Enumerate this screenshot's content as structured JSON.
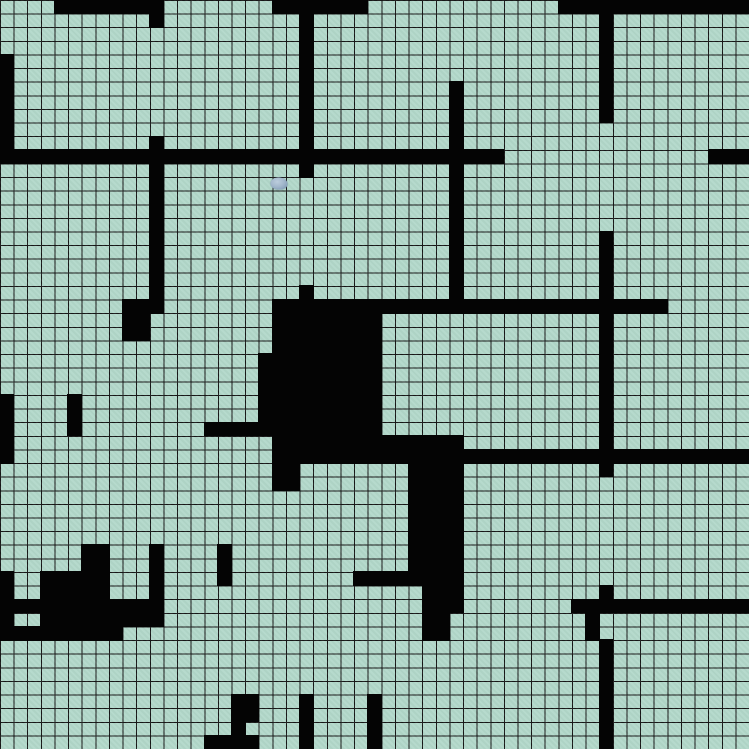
{
  "map": {
    "grid": {
      "cols": 55,
      "rows": 55,
      "cell_px": 13.6182
    },
    "colors": {
      "floor": "#b2d8ca",
      "grid_line": "#161616",
      "wall": "#040404",
      "token_body": "#a3b8cc",
      "token_edge": "#7e96b2"
    },
    "legend": {
      "wall_char": "#",
      "floor_char": ".",
      "token_char": "o"
    },
    "token": {
      "col": 20,
      "row": 13,
      "name": "blue-token"
    },
    "rows": [
      "....########........#######..............##############",
      "...........#..........#.....................#..........",
      "......................#.....................#..........",
      "......................#.....................#..........",
      "#.....................#.....................#..........",
      "#.....................#.....................#..........",
      "#.....................#..........#..........#..........",
      "#.....................#..........#..........#..........",
      "#.....................#..........#..........#..........",
      "#.....................#..........#.....................",
      "#..........#..........#..........#.....................",
      "#####################################...............###",
      "...........#..........#..........#.....................",
      "...........#........o............#.....................",
      "...........#.....................#.....................",
      "...........#.....................#.....................",
      "...........#.....................#.....................",
      "...........#.....................#..........#..........",
      "...........#.....................#..........#..........",
      "...........#.....................#..........#..........",
      "...........#.....................#..........#..........",
      "...........#..........#..........#..........#..........",
      ".........###........#############################......",
      ".........##.........########................#..........",
      ".........##.........########................#..........",
      "....................########................#..........",
      "...................#########................#..........",
      "...................#########................#..........",
      "...................#########................#..........",
      "#....#.............#########................#..........",
      "#....#.............#########................#..........",
      "#....#.........#############................#..........",
      "#...................##############..........#..........",
      "#...................###################################",
      "....................##........####..........#..........",
      "....................##........####.....................",
      "..............................####.....................",
      "..............................####.....................",
      "..............................####.....................",
      "..............................####.....................",
      "......##...#....#.............####.....................",
      "......##...#....#.............####.....................",
      "#..#####...#....#.........########.....................",
      "#..#####...#...................###..........#..........",
      "############...................###........#############",
      "#..#########...................##..........#..........",
      "#########......................##..........#..........",
      "............................................#..........",
      "............................................#..........",
      "............................................#..........",
      "............................................#..........",
      ".................##...#....#................#..........",
      ".................##...#....#................#..........",
      ".................#....#....#................#..........",
      "...............####...#....#................#..........",
      "...............####...#....#................#.........."
    ]
  }
}
